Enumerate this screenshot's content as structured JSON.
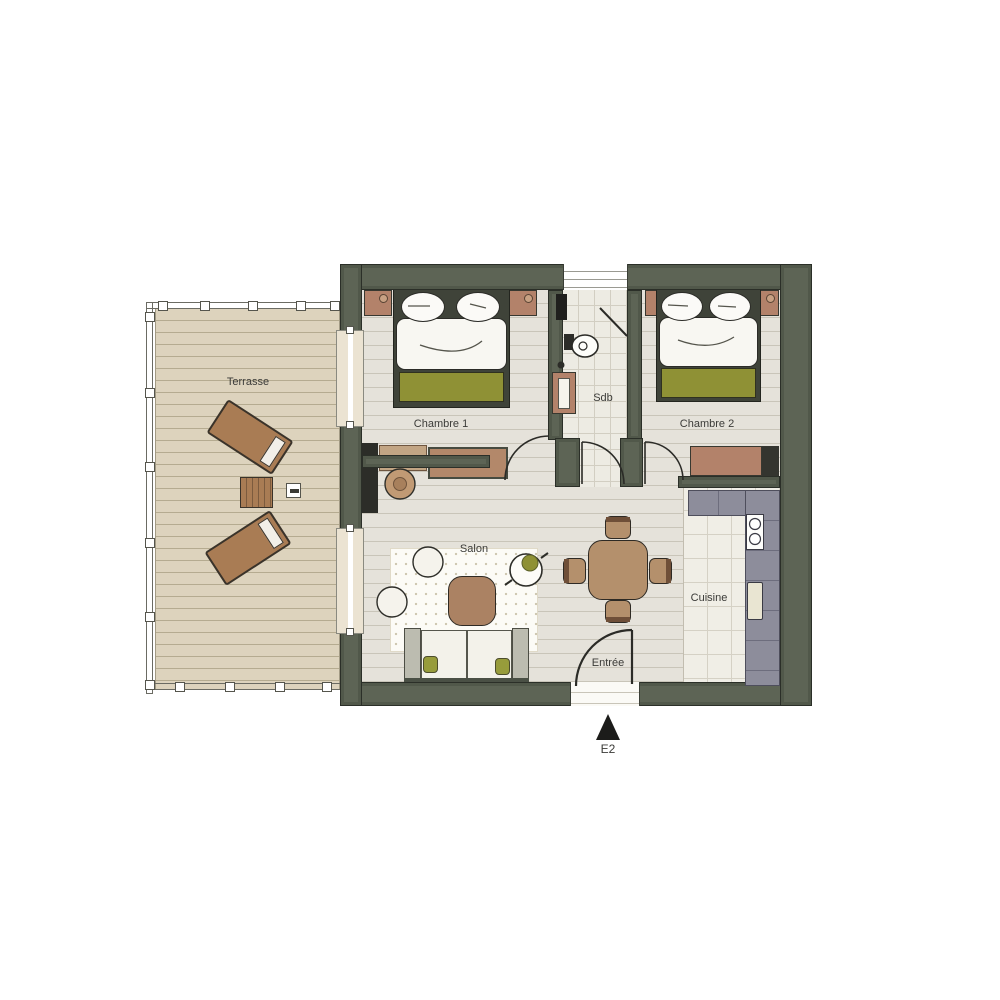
{
  "rooms": {
    "terrasse": {
      "label": "Terrasse"
    },
    "chambre1": {
      "label": "Chambre 1"
    },
    "sdb": {
      "label": "Sdb"
    },
    "chambre2": {
      "label": "Chambre 2"
    },
    "salon": {
      "label": "Salon"
    },
    "cuisine": {
      "label": "Cuisine"
    },
    "entree": {
      "label": "Entrée"
    }
  },
  "marker": {
    "label": "E2"
  },
  "colors": {
    "wall": "#5d6455",
    "wall_outline": "#2b2f28",
    "floor_wood": "#e5e2da",
    "floor_plank_line": "#c9c5b9",
    "terrace_deck": "#ddd3bd",
    "terrace_plank_line": "#b5ab90",
    "tile": "#edebe3",
    "tile_line": "#d2cec2",
    "kitchen_counter": "#8d8d9b",
    "furniture_brown": "#b3826a",
    "table_tan": "#b4906c",
    "blanket_olive": "#8f9135",
    "linen_white": "#f8f7f2",
    "marker_black": "#1c1c1a",
    "label_text": "#3b3b38"
  },
  "furniture": {
    "terrasse": [
      "lounge-chair",
      "lounge-chair",
      "slatted-side-table",
      "small-box"
    ],
    "chambre1": [
      "double-bed",
      "nightstand",
      "nightstand"
    ],
    "sdb": [
      "toilet",
      "washbasin-vanity",
      "shower-corner",
      "radiator"
    ],
    "chambre2": [
      "double-bed",
      "nightstand",
      "nightstand",
      "dresser",
      "wardrobe"
    ],
    "salon": [
      "sofa",
      "coffee-table",
      "rug",
      "pouf",
      "pouf",
      "desk",
      "stool",
      "basket-plant",
      "media-block"
    ],
    "cuisine": [
      "dining-table",
      "chair",
      "chair",
      "chair",
      "chair",
      "l-counter",
      "cooktop",
      "sink"
    ]
  }
}
